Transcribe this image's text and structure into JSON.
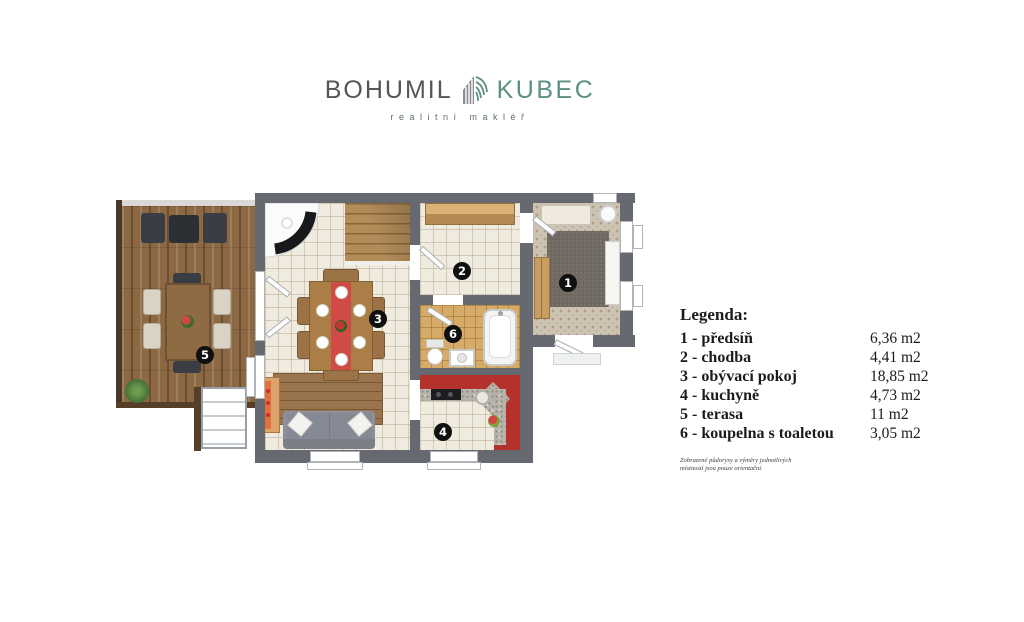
{
  "logo": {
    "first": "BOHUMIL",
    "last": "KUBEC",
    "subtitle": "realitní makléř",
    "icon": "building-fan-icon",
    "first_color": "#565558",
    "last_color": "#5b9185"
  },
  "legend": {
    "title": "Legenda:",
    "rows": [
      {
        "num": "1",
        "label": "1 - předsíň",
        "area": "6,36 m2"
      },
      {
        "num": "2",
        "label": "2 - chodba",
        "area": "4,41 m2"
      },
      {
        "num": "3",
        "label": "3 - obývací pokoj",
        "area": "18,85 m2"
      },
      {
        "num": "4",
        "label": "4 - kuchyně",
        "area": "4,73 m2"
      },
      {
        "num": "5",
        "label": "5 - terasa",
        "area": "11 m2"
      },
      {
        "num": "6",
        "label": "6 - koupelna s toaletou",
        "area": "3,05 m2"
      }
    ],
    "disclaimer_line1": "Zobrazené půdorysy a výměry jednotlivých",
    "disclaimer_line2": "místností jsou pouze orientační."
  },
  "colors": {
    "wall": "#666a70",
    "kitchen_red": "#b5312c",
    "logo_teal": "#5b9185",
    "badge": "#101010",
    "deck_wood": "#8d6943",
    "floor_cream": "#f0ebdf"
  }
}
